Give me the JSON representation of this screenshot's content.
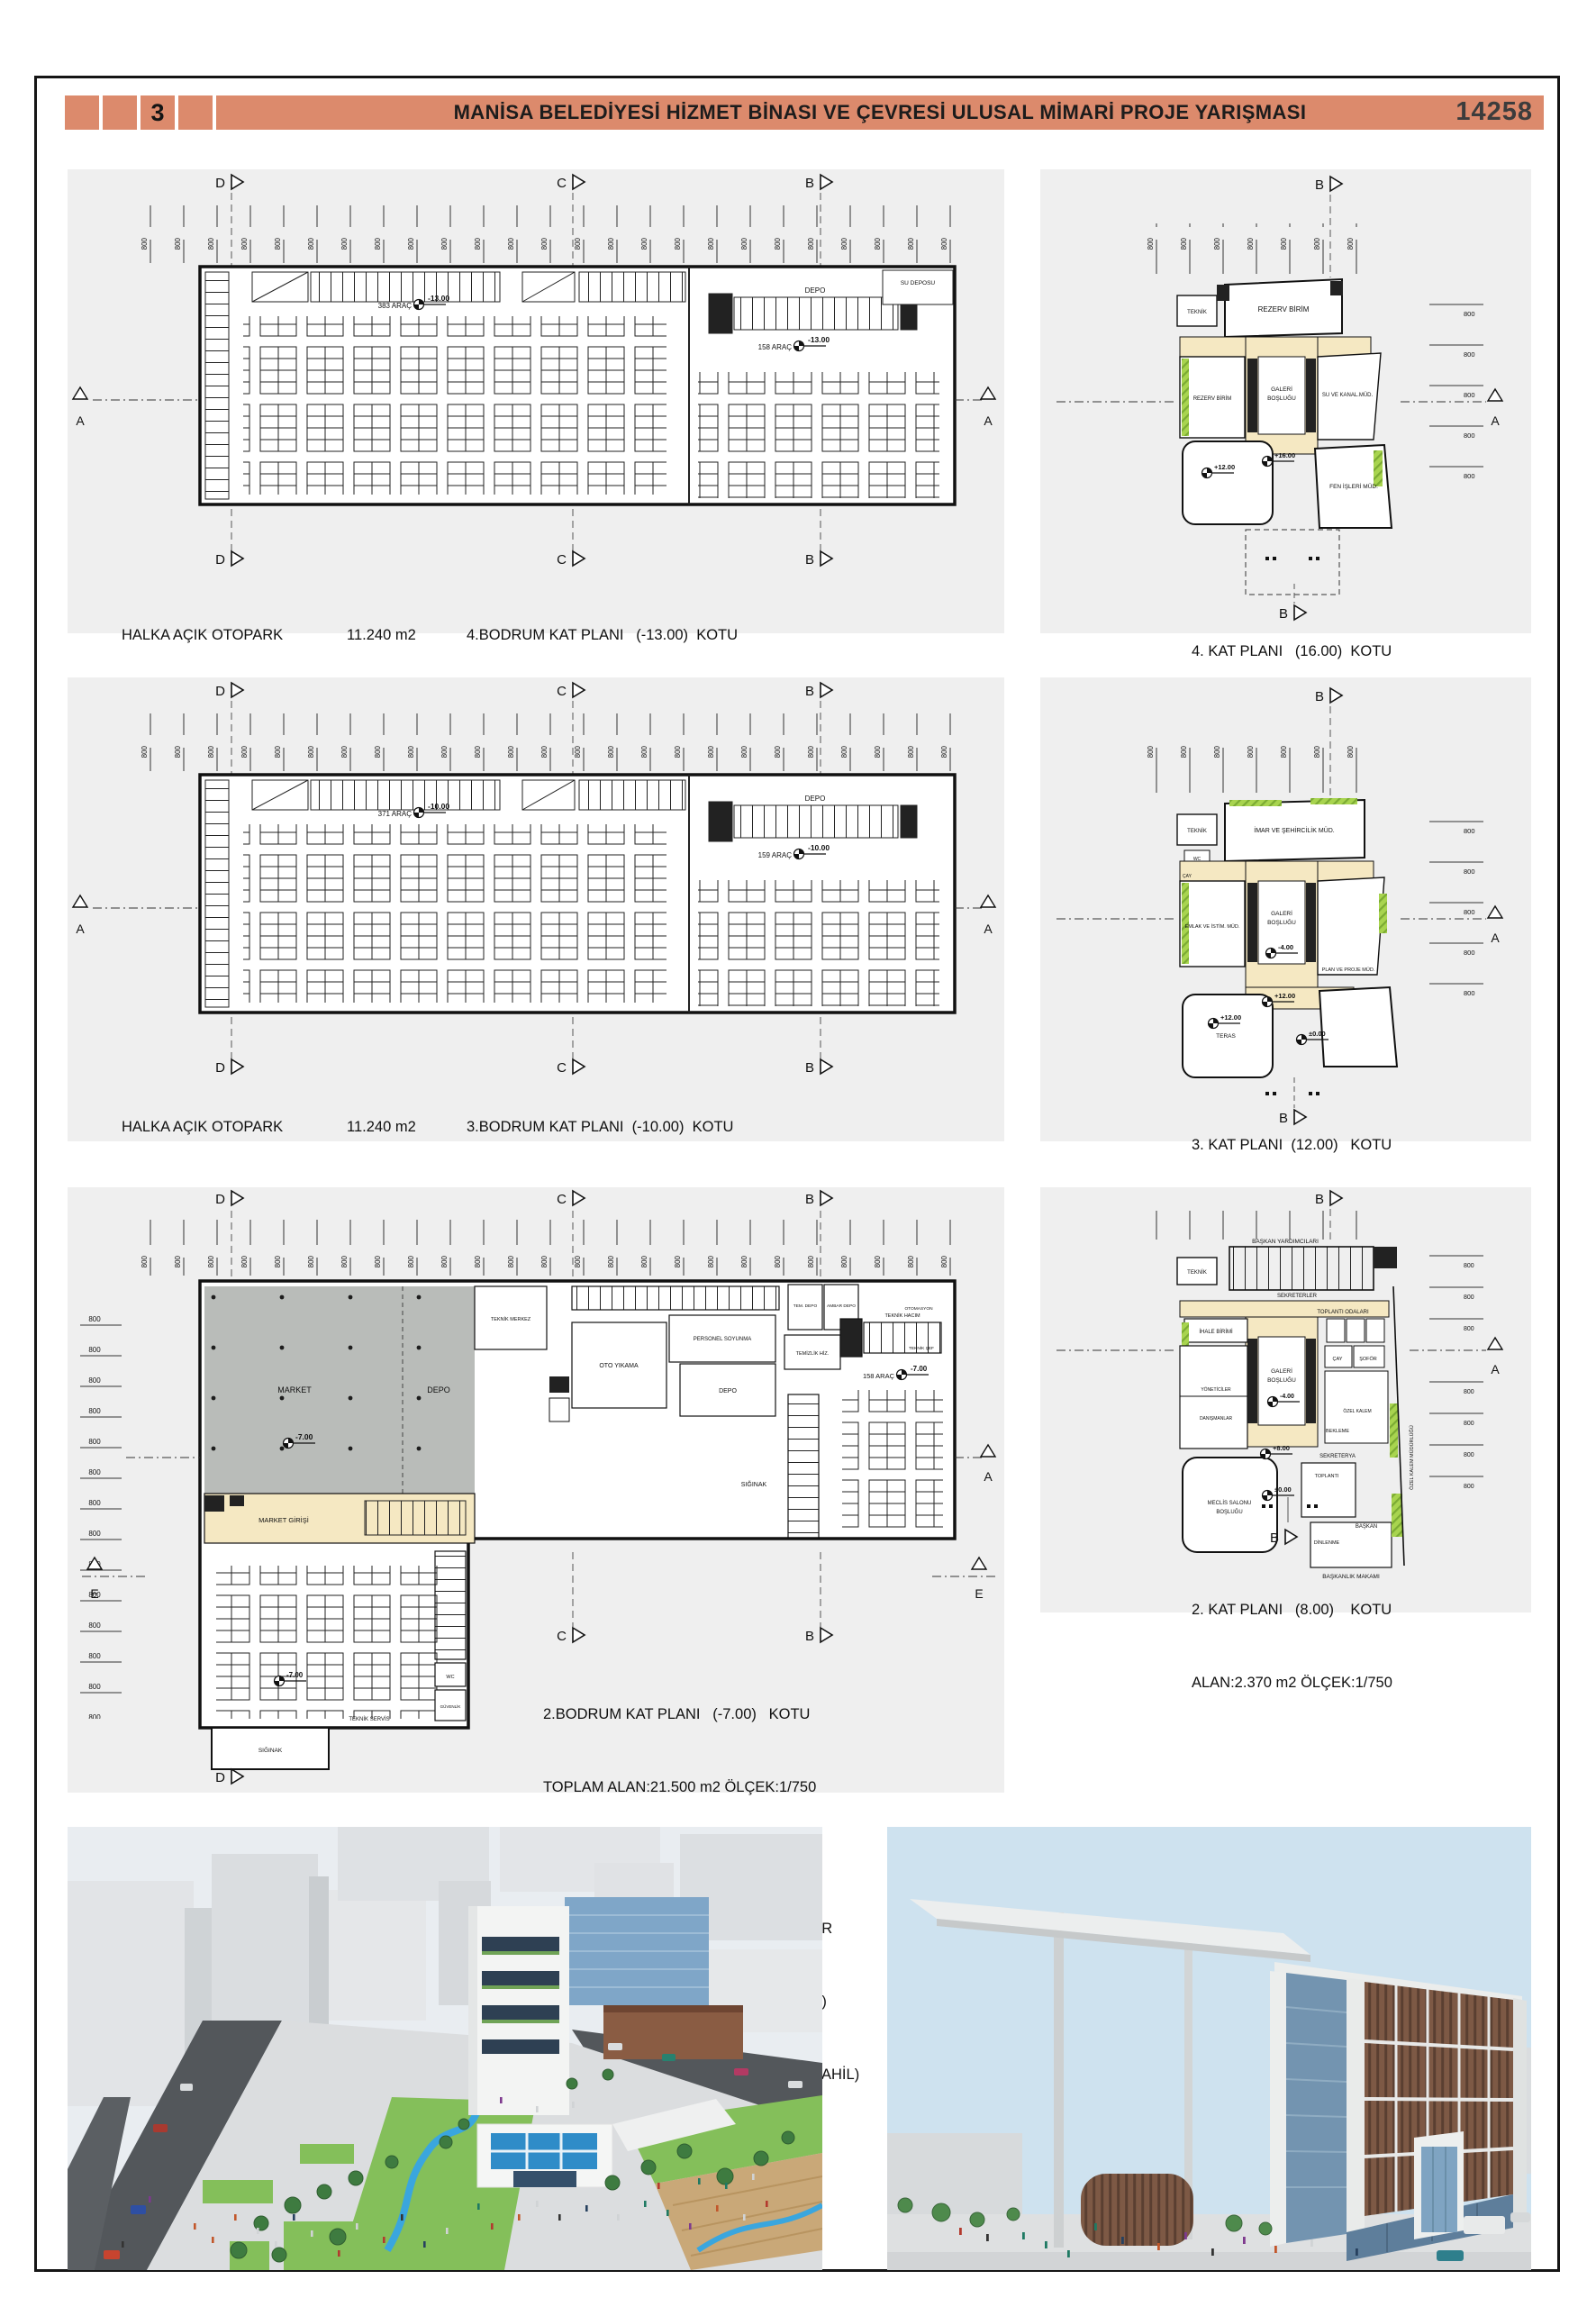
{
  "header": {
    "board_no": "3",
    "title": "MANİSA BELEDİYESİ HİZMET BİNASI VE ÇEVRESİ ULUSAL MİMARİ PROJE YARIŞMASI",
    "project_no": "14258"
  },
  "markers": {
    "a": "A",
    "b": "B",
    "c": "C",
    "d": "D",
    "e": "E"
  },
  "dim_label": "800",
  "floor4b": {
    "stat1_label": "HALKA AÇIK OTOPARK",
    "stat1_value": "11.240 m2",
    "stat2_label": "BELEDİYEYE AİT OTOPARK",
    "stat2_value": "5.660 m2",
    "caption1": "4.BODRUM KAT PLANI   (-13.00)  KOTU",
    "caption2": "TOPLAM ALAN:16.900 m2 ÖLÇEK:1/750",
    "cars_main": "383 ARAÇ",
    "level_main": "-13.00",
    "cars_side": "158 ARAÇ",
    "level_side": "-13.00",
    "depo": "DEPO",
    "su_deposu": "SU DEPOSU"
  },
  "floor3b": {
    "stat1_label": "HALKA AÇIK OTOPARK",
    "stat1_value": "11.240 m2",
    "stat2_label": "BELEDİYEYE AİT OTOPARK",
    "stat2_value": "5.660 m2",
    "caption1": "3.BODRUM KAT PLANI  (-10.00)  KOTU",
    "caption2": "TOPLAM ALAN:16.900 m2 ÖLÇEK:1/750",
    "cars_main": "371 ARAÇ",
    "level_main": "-10.00",
    "cars_side": "159 ARAÇ",
    "level_side": "-10.00",
    "depo": "DEPO"
  },
  "floor2b": {
    "caption1": "2.BODRUM KAT PLANI   (-7.00)   KOTU",
    "caption2": "TOPLAM ALAN:21.500 m2 ÖLÇEK:1/750",
    "stats": [
      {
        "label": "SOSYAL,KÜLTÜREL VE TİCARİ BİRİMLER",
        "value": "3.960 m2"
      },
      {
        "label": "HALKA AÇIK OTOPARK (SIĞINAK DAHİL)",
        "value": "10.740 m2"
      },
      {
        "label": "BELEDİYEYE AİT OTOPARK (SIĞINAK DAHİL)",
        "value": "6.800 m2"
      }
    ],
    "market": "MARKET",
    "depo": "DEPO",
    "teknik_merkez": "TEKNİK MERKEZ",
    "market_girisi": "MARKET GİRİŞİ",
    "oto_yikama": "OTO YIKAMA",
    "personel_soyunma": "PERSONEL SOYUNMA",
    "depo2": "DEPO",
    "tem_depo": "TEM. DEPO",
    "ambar_depo": "AMBAR DEPO",
    "temizlik": "TEMİZLİK HİZ.",
    "teknik_hacim": "TEKNİK HACIM",
    "otomasyon": "OTOMASYON",
    "teknik_sef": "TEKNİK ŞEF",
    "siginak": "SIĞINAK",
    "siginak_alt": "SIĞINAK",
    "teknik_servis": "TEKNİK SERVİS",
    "wc": "WC",
    "guvenlik": "GÜVENLİK",
    "cars_side": "158 ARAÇ",
    "level_side": "-7.00",
    "level_market": "-7.00",
    "level_wing": "-7.00"
  },
  "floor4": {
    "caption1": "4. KAT PLANI   (16.00)  KOTU",
    "caption2": "ALAN:2.100 m2 ÖLÇEK:1/750",
    "teknik": "TEKNİK",
    "rezerv_top": "REZERV BİRİM",
    "rezerv_left": "REZERV BİRİM",
    "galeri1": "GALERİ",
    "galeri2": "BOŞLUĞU",
    "su_kanal": "SU VE KANAL.MÜD.",
    "fen": "FEN İŞLERİ MÜD.",
    "l16": "+16.00",
    "l12": "+12.00"
  },
  "floor3": {
    "caption1": "3. KAT PLANI  (12.00)   KOTU",
    "caption2": "ALAN:2.370 m2 ÖLÇEK:1/750",
    "teknik": "TEKNİK",
    "wc": "WC",
    "cay": "ÇAY",
    "imar": "İMAR VE ŞEHİRCİLİK MÜD.",
    "emlak": "EMLAK VE İSTİM. MÜD.",
    "galeri1": "GALERİ",
    "galeri2": "BOŞLUĞU",
    "plan_proje": "PLAN VE PROJE MÜD.",
    "teras": "TERAS",
    "m4": "-4.00",
    "p12a": "+12.00",
    "p12b": "+12.00",
    "zero": "±0.00"
  },
  "floor2": {
    "caption1": "2. KAT PLANI   (8.00)    KOTU",
    "caption2": "ALAN:2.370 m2 ÖLÇEK:1/750",
    "baskan_yrd": "BAŞKAN YARDIMCILARI",
    "teknik": "TEKNİK",
    "sekreterler": "SEKRETERLER",
    "toplanti_odalari": "TOPLANTI ODALARI",
    "ihale": "İHALE BİRİMİ",
    "galeri1": "GALERİ",
    "galeri2": "BOŞLUĞU",
    "yoneticiler": "YÖNETİCİLER",
    "danismanlar": "DANIŞMANLAR",
    "cay": "ÇAY",
    "sofor": "ŞOFÖR",
    "ozel_kalem": "ÖZEL KALEM",
    "bekleme": "BEKLEME",
    "sekreterya": "SEKRETERYA",
    "toplanti": "TOPLANTI",
    "meclis1": "MECLİS SALONU",
    "meclis2": "BOŞLUĞU",
    "dinlenme": "DİNLENME",
    "baskan": "BAŞKAN",
    "baskanlik": "BAŞKANLIK MAKAMI",
    "ozel_kalem_mud": "ÖZEL KALEM MÜDÜRLÜĞÜ",
    "m4": "-4.00",
    "p8": "+8.00",
    "zero": "±0.00"
  },
  "colors": {
    "header_accent": "#DC8A6C",
    "corridor_cream": "#F5E8C2",
    "hatch_green": "#A8D44F",
    "market_gray": "#B9BCB9"
  }
}
